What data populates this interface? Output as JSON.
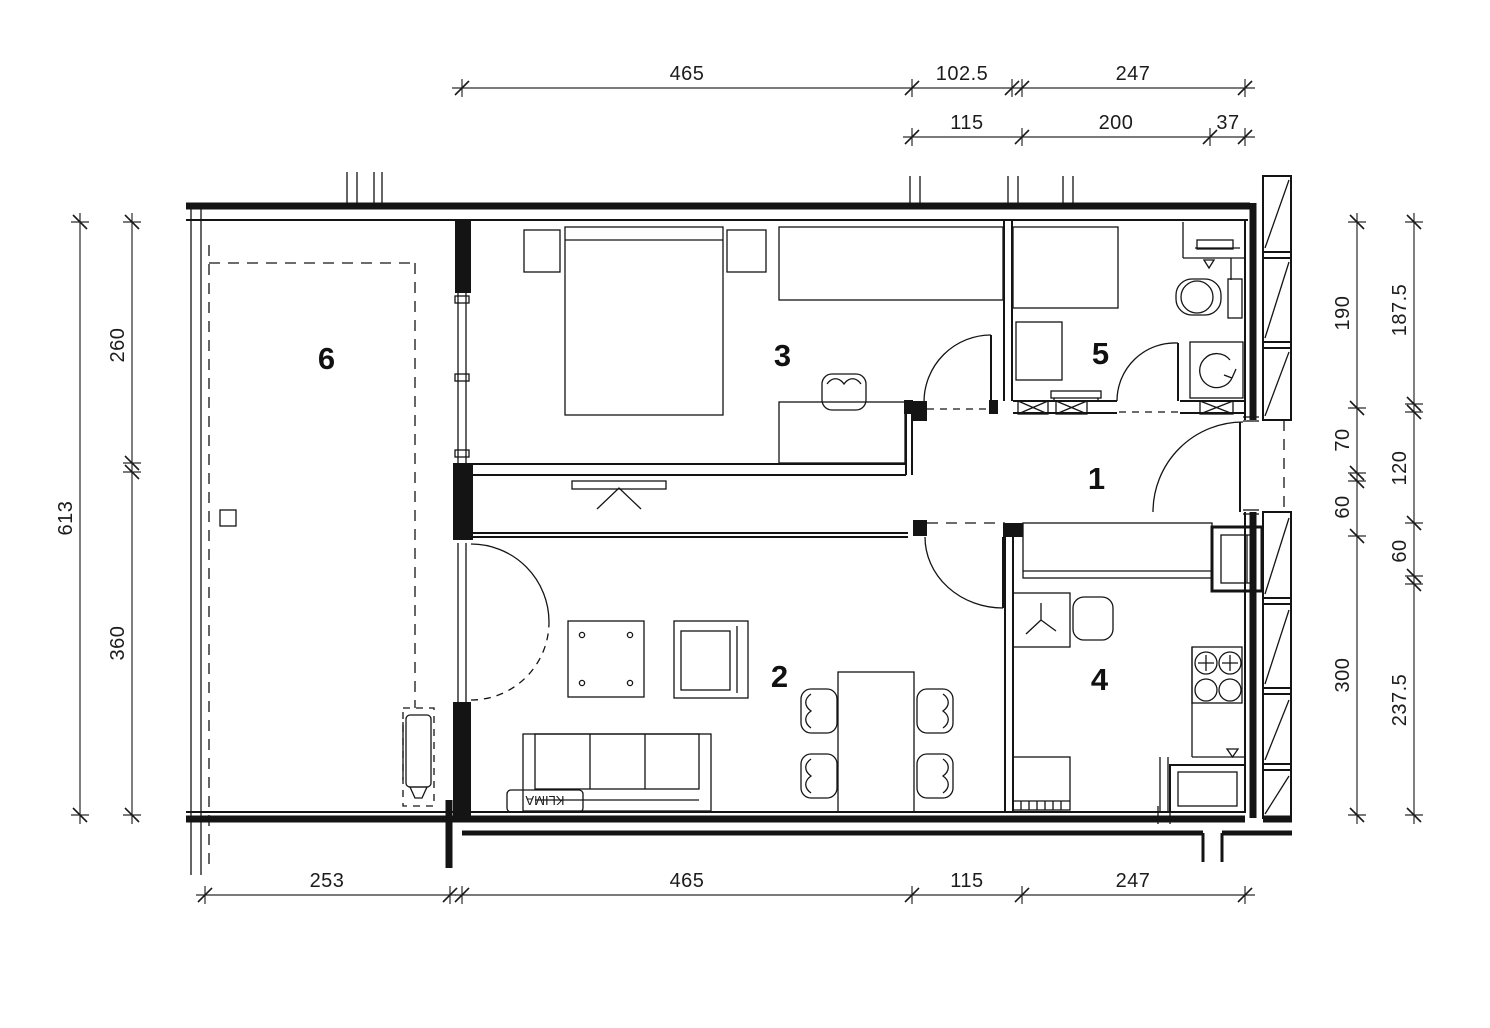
{
  "palette": {
    "line": "#141414",
    "background": "#ffffff"
  },
  "rooms": {
    "hall": "1",
    "living_room": "2",
    "bedroom": "3",
    "kitchen": "4",
    "bathroom": "5",
    "terrace": "6"
  },
  "labels": {
    "ac_unit": "KLIMA"
  },
  "dimensions": {
    "top_row1": [
      "465",
      "102.5",
      "247"
    ],
    "top_row2": [
      "115",
      "200",
      "37"
    ],
    "left_outer": [
      "613"
    ],
    "left_inner": [
      "260",
      "360"
    ],
    "right_inner": [
      "190",
      "70",
      "60",
      "300"
    ],
    "right_outer": [
      "187.5",
      "120",
      "60",
      "237.5"
    ],
    "bottom": [
      "253",
      "465",
      "115",
      "247"
    ]
  }
}
